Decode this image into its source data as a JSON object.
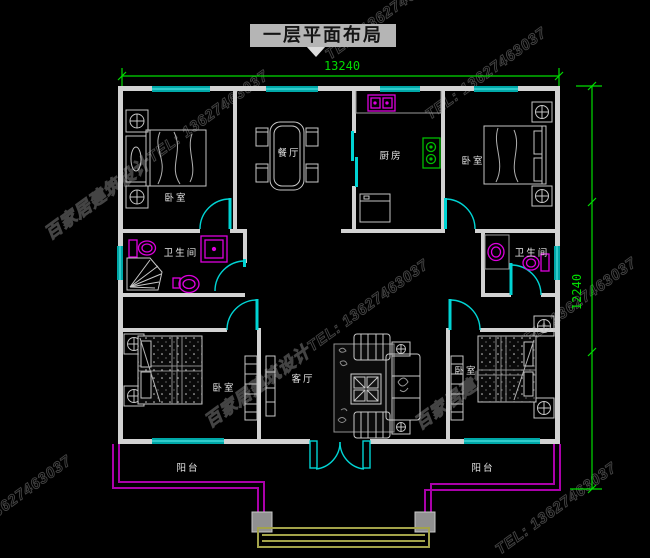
{
  "title": "一层平面布局",
  "dimensions": {
    "width": "13240",
    "height": "12240"
  },
  "rooms": {
    "bedroom_tl": "卧室",
    "dining": "餐厅",
    "kitchen": "厨房",
    "bedroom_tr": "卧室",
    "bathroom_left": "卫生间",
    "bathroom_right": "卫生间",
    "bedroom_bl": "卧室",
    "living": "客厅",
    "bedroom_br": "卧室",
    "balcony_left": "阳台",
    "balcony_right": "阳台"
  },
  "watermark": {
    "brand": "百家居建筑设计",
    "phone": "TEL: 13627463037"
  },
  "colors": {
    "background": "#000000",
    "wall": "#d2d2d2",
    "window_door": "#00c8c8",
    "fixture_magenta": "#dd00dd",
    "railing_purple": "#aa00aa",
    "dimension_green": "#00dc00",
    "stove_green": "#00bb00",
    "steps_olive": "#a3a34a",
    "furniture_gray": "#c4c4c4"
  }
}
